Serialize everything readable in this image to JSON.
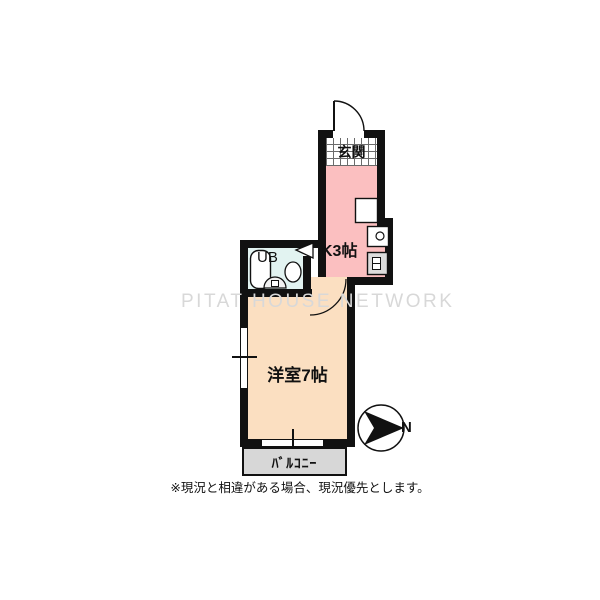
{
  "watermark": {
    "text": "PITAT HOUSE NETWORK",
    "color": "#d8d8d8"
  },
  "note": {
    "text": "※現況と相違がある場合、現況優先とします。"
  },
  "compass": {
    "label": "N",
    "pointing": "right"
  },
  "rooms": {
    "entrance": {
      "label": "玄関",
      "floor": "tile-grid"
    },
    "kitchen": {
      "label": "K3帖",
      "fill": "#fbbfc0"
    },
    "bath": {
      "label": "UB",
      "fill": "#e2f3f1"
    },
    "living": {
      "label": "洋室7帖",
      "fill": "#fbdfc1"
    },
    "balcony": {
      "label": "ﾊﾞﾙｺﾆｰ",
      "fill": "#d7d7d7"
    }
  },
  "colors": {
    "wall": "#111111",
    "watermark": "#d8d8d8",
    "background": "#ffffff"
  }
}
